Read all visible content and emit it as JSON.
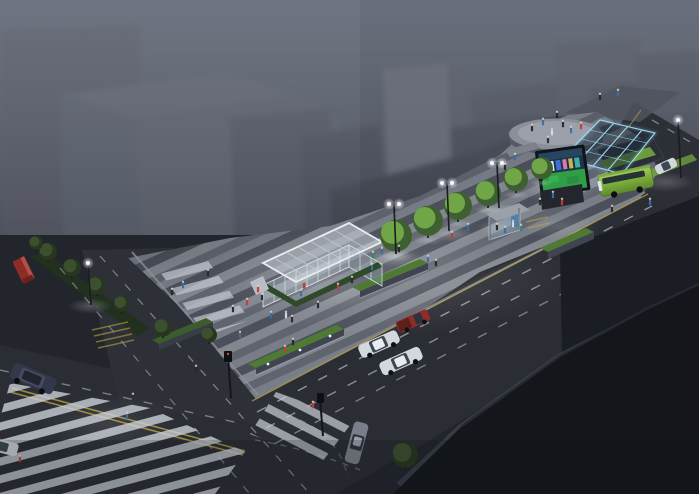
{
  "scene": {
    "alt": "Night-time aerial architectural rendering of an urban transit plaza: striped pedestrian promenade with glass pavilion, tree rows, glowing glazed station canopy with LED media screen, circular platform, green bus and street intersection with zebra crossings",
    "time_of_day": "night",
    "view": "aerial-isometric"
  },
  "palette": {
    "fog": "#7a7f8d",
    "building_mass": "#4a4e59",
    "dark_mass": "#14161b",
    "asphalt": "#2b2d35",
    "plaza_light": "#82878f",
    "plaza_dark": "#4c505a",
    "crosswalk_white": "#c9ced6",
    "lane_yellow": "#b9a23e",
    "tree_lit": "#74aa4a",
    "tree_dim": "#3c5230",
    "bus_green": "#7fae3f",
    "canopy_blue": "#8fd2ec",
    "screen_green": "#2f9e46",
    "vehicle_white": "#d3d7de",
    "vehicle_red": "#8e2c28",
    "suv_dark": "#33374a",
    "sedan_gray": "#7a7e88",
    "planter_green": "#4e7a34",
    "hedge_green": "#2f4a28",
    "glow_white": "#ffffff",
    "glow_blue": "#bfe8ff"
  },
  "objects": {
    "glass_pavilion": "glass pavilion entrance",
    "transit_canopy": "glowing glazed station canopy",
    "media_screen": "LED media screen",
    "circular_platform": "circular plaza platform",
    "bus_shelter": "bus shelter",
    "bus": "green city bus",
    "intersection": "street intersection with zebra crossings"
  },
  "trees": {
    "lit": [
      [
        396,
        254,
        16
      ],
      [
        428,
        238,
        15
      ],
      [
        458,
        222,
        14
      ],
      [
        488,
        208,
        13
      ],
      [
        516,
        193,
        12
      ],
      [
        542,
        181,
        11
      ]
    ],
    "dim": [
      [
        48,
        262,
        9
      ],
      [
        72,
        278,
        9
      ],
      [
        97,
        296,
        9
      ],
      [
        122,
        313,
        8
      ],
      [
        163,
        338,
        9
      ],
      [
        209,
        344,
        8
      ],
      [
        36,
        251,
        7
      ],
      [
        405,
        470,
        13
      ]
    ]
  },
  "lamps": {
    "double": [
      [
        394,
        204,
        50
      ],
      [
        447,
        183,
        48
      ],
      [
        497,
        163,
        45
      ]
    ],
    "single": [
      [
        88,
        263,
        42
      ],
      [
        678,
        120,
        58
      ]
    ]
  },
  "glows": [
    [
      390,
      278,
      190,
      58,
      0.15,
      "w"
    ],
    [
      318,
      286,
      66,
      24,
      0.17,
      "w"
    ],
    [
      396,
      258,
      26,
      9,
      0.3,
      "w"
    ],
    [
      450,
      234,
      24,
      8,
      0.28,
      "w"
    ],
    [
      498,
      210,
      22,
      7,
      0.26,
      "w"
    ],
    [
      90,
      306,
      22,
      8,
      0.25,
      "w"
    ],
    [
      666,
      182,
      28,
      10,
      0.22,
      "w"
    ],
    [
      612,
      172,
      55,
      22,
      0.25,
      "b"
    ],
    [
      560,
      186,
      38,
      20,
      0.3,
      "w"
    ],
    [
      556,
      134,
      52,
      17,
      0.14,
      "w"
    ],
    [
      110,
      424,
      70,
      30,
      0.1,
      "w"
    ],
    [
      560,
      226,
      42,
      13,
      0.12,
      "w"
    ],
    [
      497,
      228,
      20,
      8,
      0.2,
      "w"
    ]
  ],
  "people": [
    [
      133,
      400,
      "#2a3040"
    ],
    [
      127,
      419,
      "#3a6ea8"
    ],
    [
      196,
      372,
      "#232833"
    ],
    [
      240,
      338,
      "#3a6ea8"
    ],
    [
      285,
      352,
      "#c23b3b"
    ],
    [
      293,
      345,
      "#232833"
    ],
    [
      313,
      408,
      "#c23b3b"
    ],
    [
      20,
      462,
      "#c23b3b"
    ],
    [
      172,
      295,
      "#232833"
    ],
    [
      183,
      288,
      "#3a6ea8"
    ],
    [
      208,
      276,
      "#232833"
    ],
    [
      233,
      312,
      "#232833"
    ],
    [
      247,
      305,
      "#c23b3b"
    ],
    [
      262,
      300,
      "#232833"
    ],
    [
      286,
      318,
      "#d8dce2"
    ],
    [
      301,
      296,
      "#3a6ea8"
    ],
    [
      318,
      308,
      "#232833"
    ],
    [
      338,
      290,
      "#c23b3b"
    ],
    [
      352,
      283,
      "#232833"
    ],
    [
      372,
      270,
      "#3a6ea8"
    ],
    [
      258,
      292,
      "#c23b3b"
    ],
    [
      271,
      318,
      "#3a6ea8"
    ],
    [
      292,
      322,
      "#232833"
    ],
    [
      373,
      258,
      "#2e8b6a"
    ],
    [
      382,
      254,
      "#3a6ea8"
    ],
    [
      428,
      262,
      "#3a6ea8"
    ],
    [
      436,
      266,
      "#232833"
    ],
    [
      399,
      252,
      "#232833"
    ],
    [
      452,
      238,
      "#c23b3b"
    ],
    [
      468,
      230,
      "#3a6ea8"
    ],
    [
      497,
      230,
      "#232833"
    ],
    [
      505,
      233,
      "#3a6ea8"
    ],
    [
      513,
      227,
      "#d8dce2"
    ],
    [
      521,
      231,
      "#2e8b6a"
    ],
    [
      540,
      205,
      "#232833"
    ],
    [
      553,
      198,
      "#3a6ea8"
    ],
    [
      562,
      205,
      "#c23b3b"
    ],
    [
      515,
      160,
      "#3a6ea8"
    ],
    [
      505,
      170,
      "#232833"
    ],
    [
      532,
      131,
      "#232833"
    ],
    [
      543,
      125,
      "#3a6ea8"
    ],
    [
      552,
      135,
      "#d8dce2"
    ],
    [
      563,
      127,
      "#232833"
    ],
    [
      571,
      133,
      "#3a6ea8"
    ],
    [
      581,
      129,
      "#c23b3b"
    ],
    [
      557,
      118,
      "#232833"
    ],
    [
      548,
      143,
      "#2a3040"
    ],
    [
      600,
      100,
      "#232833"
    ],
    [
      618,
      96,
      "#3a6ea8"
    ],
    [
      612,
      212,
      "#232833"
    ],
    [
      650,
      205,
      "#3a6ea8"
    ]
  ]
}
